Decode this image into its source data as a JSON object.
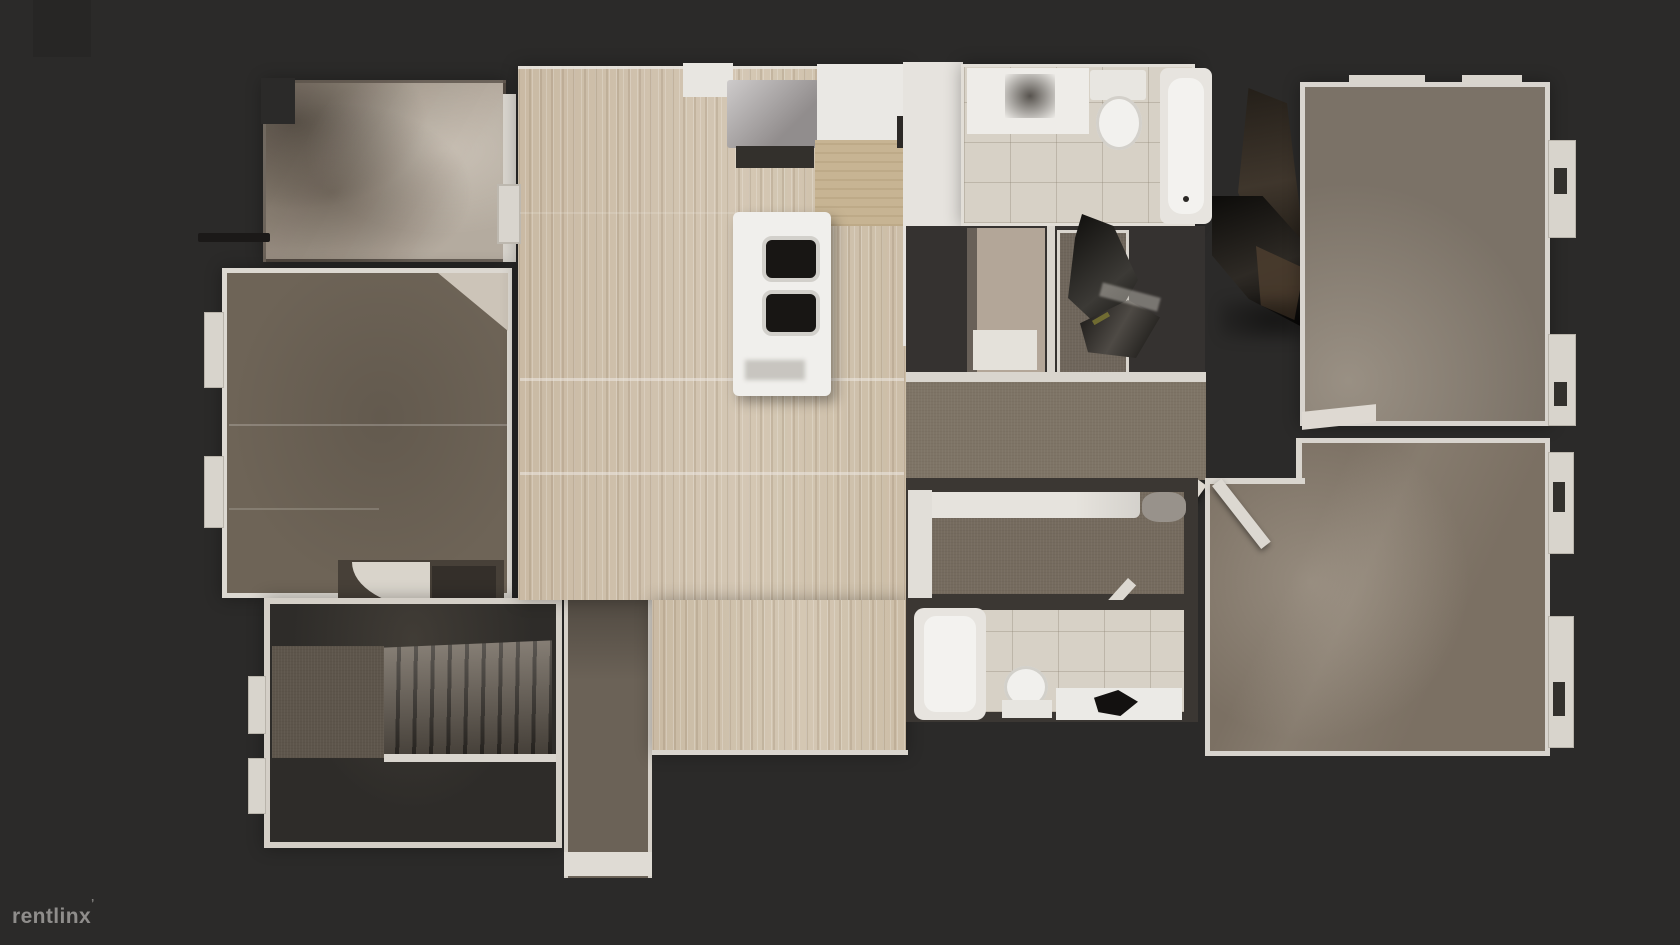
{
  "watermark": {
    "brand": "rentlinx",
    "mark": "ʼ"
  },
  "scene": {
    "type": "3d-dollhouse-top-down-floor-plan-scan",
    "background": "#2b2a29"
  },
  "palette": {
    "background": "#2b2a29",
    "wall": "#d9d5ce",
    "wall_dark": "#3b3733",
    "wood": "#cfc1ab",
    "tile": "#d7d1c6",
    "fixture_white": "#f0efec",
    "sink_dark": "#181614",
    "garage_floor": "#a89d90",
    "butcher_block": "#c7b493",
    "appliance_gray": "#a5a0a0",
    "laundry_floor": "#b3a698",
    "carpet_left": "#6e6457",
    "carpet_right_top": "#7b7267",
    "carpet_right_bottom": "#7b7063",
    "carpet_hall": "#7e7466",
    "carpet_small_bedroom": "#756b5e",
    "carpet_closet": "#6f665b",
    "carpet_entry": "#5d554b",
    "carpet_landing": "#6b6257",
    "dark_floor": "#2e2c29",
    "utility_dark": "#353230",
    "closet_dark": "#474038",
    "clutter_dark": "#17150f",
    "furniture_brown": "#4a3c2d"
  },
  "rooms": [
    {
      "id": "garage",
      "label": "garage / storage room",
      "floor": "bare concrete"
    },
    {
      "id": "bedroom-left",
      "label": "left bedroom",
      "floor": "carpet"
    },
    {
      "id": "entry-stairs",
      "label": "entry with staircase down",
      "floor": "carpet and stairs"
    },
    {
      "id": "living-kitchen",
      "label": "kitchen / living area with island",
      "floor": "light wood plank"
    },
    {
      "id": "bathroom-top",
      "label": "upper bathroom with tub and toilet",
      "floor": "tile"
    },
    {
      "id": "laundry",
      "label": "laundry nook",
      "floor": "vinyl"
    },
    {
      "id": "hallway",
      "label": "hallway",
      "floor": "carpet"
    },
    {
      "id": "bedroom-right-top",
      "label": "upper right bedroom",
      "floor": "carpet"
    },
    {
      "id": "bedroom-middle",
      "label": "middle bedroom",
      "floor": "carpet"
    },
    {
      "id": "bathroom-bottom",
      "label": "lower bathroom with tub, toilet, vanity",
      "floor": "tile"
    },
    {
      "id": "bedroom-right-bottom",
      "label": "lower right bedroom",
      "floor": "carpet"
    }
  ],
  "fixtures": [
    "refrigerator",
    "kitchen-island-double-sink",
    "butcher-block-counter",
    "bathroom-vanity",
    "toilet",
    "bathtub",
    "staircase",
    "closet-door-swings",
    "window-bays",
    "washer-appliance",
    "bed-with-white-cover"
  ]
}
